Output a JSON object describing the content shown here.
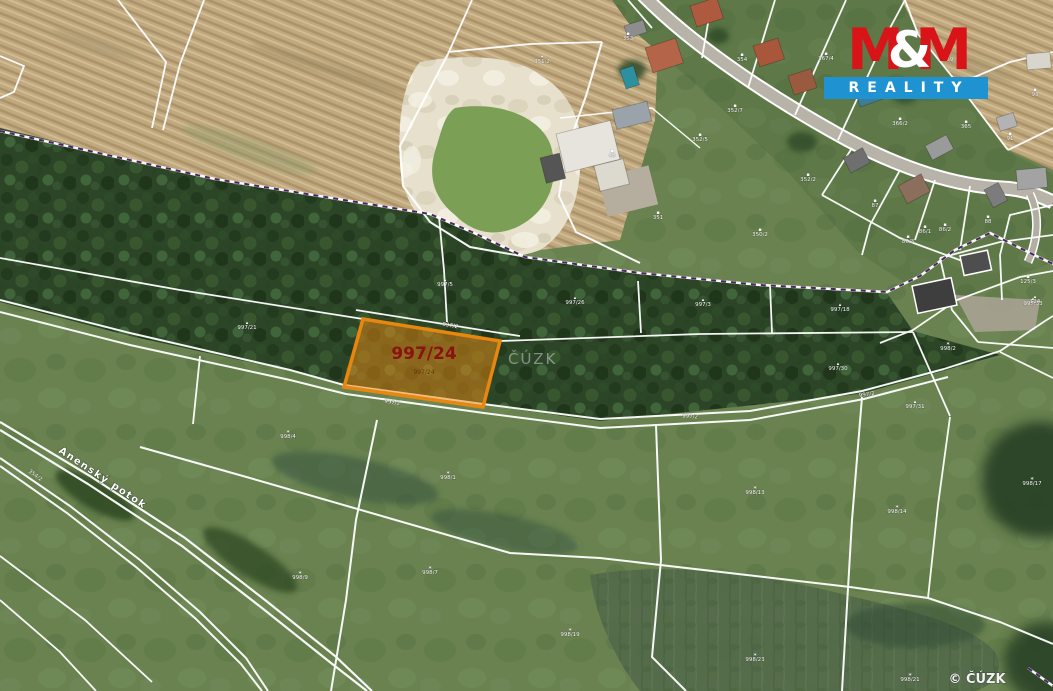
{
  "branding": {
    "logo_m1": "M",
    "logo_amp": "&",
    "logo_m2": "M",
    "logo_text": "REALITY",
    "logo_red": "#d81419",
    "logo_blue": "#1f93d1"
  },
  "map": {
    "highlight": {
      "parcel_label": "997/24",
      "parcel_sublabel": "997/24",
      "fill": "#e78a12",
      "border": "#e8870f",
      "label_color": "#8b1210"
    },
    "watermark_center": "ČÚZK",
    "copyright": "© ČÚZK",
    "stream_label": "Anenský potok",
    "stream_label_secondary": "354/2",
    "boundary_color": "#4b2460",
    "parcel_line_color": "#ffffff",
    "icon_glyphs": {
      "tree": "▴",
      "grass": "∗",
      "house": "▪",
      "path": ""
    },
    "minor_labels": [
      {
        "x": 247,
        "y": 329,
        "icon": "tree",
        "text": "997/21"
      },
      {
        "x": 445,
        "y": 286,
        "icon": "tree",
        "text": "997/5"
      },
      {
        "x": 575,
        "y": 304,
        "icon": "tree",
        "text": "997/26"
      },
      {
        "x": 703,
        "y": 306,
        "icon": "tree",
        "text": "997/3"
      },
      {
        "x": 840,
        "y": 311,
        "icon": "tree",
        "text": "997/18"
      },
      {
        "x": 1033,
        "y": 305,
        "icon": "tree",
        "text": "997/33"
      },
      {
        "x": 838,
        "y": 370,
        "icon": "tree",
        "text": "997/30"
      },
      {
        "x": 915,
        "y": 408,
        "icon": "tree",
        "text": "997/31"
      },
      {
        "x": 1035,
        "y": 303,
        "icon": "tree",
        "text": "124"
      },
      {
        "x": 450,
        "y": 327,
        "icon": "path",
        "text": "997/2",
        "rot": 9
      },
      {
        "x": 392,
        "y": 404,
        "icon": "path",
        "text": "997/2",
        "rot": 8
      },
      {
        "x": 690,
        "y": 418,
        "icon": "path",
        "text": "997/2",
        "rot": 3
      },
      {
        "x": 867,
        "y": 396,
        "icon": "path",
        "text": "997/2",
        "rot": -8
      },
      {
        "x": 948,
        "y": 350,
        "icon": "grass",
        "text": "998/2"
      },
      {
        "x": 288,
        "y": 438,
        "icon": "grass",
        "text": "998/4"
      },
      {
        "x": 448,
        "y": 479,
        "icon": "grass",
        "text": "998/1"
      },
      {
        "x": 300,
        "y": 579,
        "icon": "grass",
        "text": "998/9"
      },
      {
        "x": 430,
        "y": 574,
        "icon": "grass",
        "text": "998/7"
      },
      {
        "x": 755,
        "y": 494,
        "icon": "grass",
        "text": "998/13"
      },
      {
        "x": 897,
        "y": 513,
        "icon": "grass",
        "text": "998/14"
      },
      {
        "x": 1032,
        "y": 485,
        "icon": "grass",
        "text": "998/17"
      },
      {
        "x": 755,
        "y": 661,
        "icon": "grass",
        "text": "998/23"
      },
      {
        "x": 910,
        "y": 681,
        "icon": "grass",
        "text": "998/21"
      },
      {
        "x": 570,
        "y": 636,
        "icon": "grass",
        "text": "998/19"
      },
      {
        "x": 628,
        "y": 40,
        "icon": "house",
        "text": "353"
      },
      {
        "x": 735,
        "y": 112,
        "icon": "house",
        "text": "352/7"
      },
      {
        "x": 826,
        "y": 60,
        "icon": "house",
        "text": "367/4"
      },
      {
        "x": 900,
        "y": 125,
        "icon": "house",
        "text": "366/2"
      },
      {
        "x": 966,
        "y": 128,
        "icon": "house",
        "text": "365"
      },
      {
        "x": 1010,
        "y": 140,
        "icon": "house",
        "text": "91"
      },
      {
        "x": 875,
        "y": 207,
        "icon": "house",
        "text": "87"
      },
      {
        "x": 925,
        "y": 233,
        "icon": "house",
        "text": "86/1"
      },
      {
        "x": 988,
        "y": 223,
        "icon": "house",
        "text": "88"
      },
      {
        "x": 808,
        "y": 181,
        "icon": "house",
        "text": "352/2"
      },
      {
        "x": 700,
        "y": 141,
        "icon": "house",
        "text": "352/5"
      },
      {
        "x": 658,
        "y": 219,
        "icon": "house",
        "text": "351"
      },
      {
        "x": 760,
        "y": 236,
        "icon": "house",
        "text": "350/2"
      },
      {
        "x": 1035,
        "y": 96,
        "icon": "house",
        "text": "93"
      },
      {
        "x": 948,
        "y": 61,
        "icon": "house",
        "text": "369"
      },
      {
        "x": 742,
        "y": 61,
        "icon": "house",
        "text": "354"
      },
      {
        "x": 612,
        "y": 157,
        "icon": "house",
        "text": "48"
      },
      {
        "x": 542,
        "y": 63,
        "icon": "grass",
        "text": "351/2"
      },
      {
        "x": 1028,
        "y": 283,
        "icon": "house",
        "text": "125/3"
      },
      {
        "x": 908,
        "y": 243,
        "icon": "house",
        "text": "86/3"
      },
      {
        "x": 945,
        "y": 231,
        "icon": "house",
        "text": "86/2"
      }
    ]
  }
}
